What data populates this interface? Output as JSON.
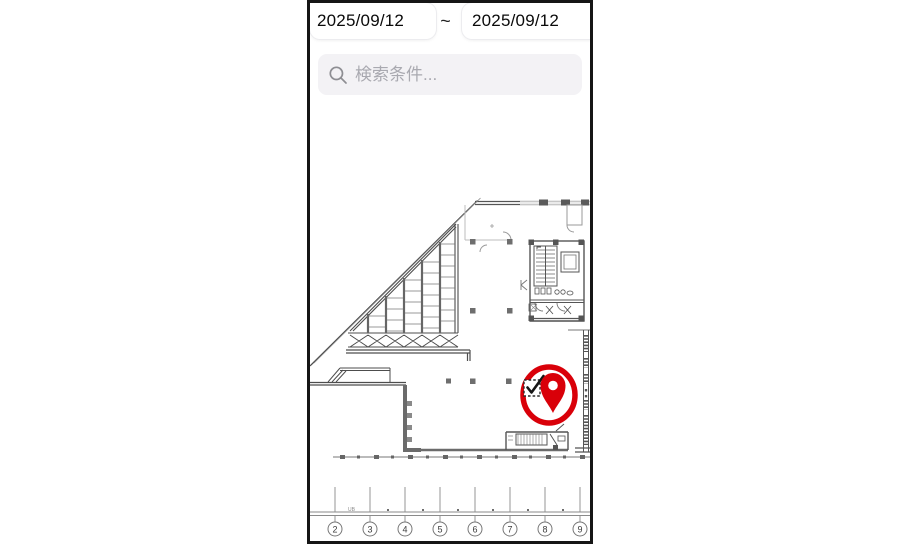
{
  "dates": {
    "start": "2025/09/12",
    "separator": "~",
    "end": "2025/09/12"
  },
  "search": {
    "placeholder": "検索条件...",
    "icon": "search-icon"
  },
  "plan": {
    "type": "architectural-floor-plan",
    "grid_labels": [
      "2",
      "3",
      "4",
      "5",
      "6",
      "7",
      "8",
      "9"
    ],
    "note_label": "UB",
    "marker": {
      "icon": "map-pin-icon",
      "badge_icon": "checkbox-checked-icon",
      "color": "#d90009"
    }
  },
  "colors": {
    "frame": "#161616",
    "search_bg": "#f3f2f5",
    "placeholder": "#a9a9b0",
    "plan_dark": "#4d4d4d",
    "plan_light": "#b9b9b9",
    "marker_red": "#d90009"
  }
}
